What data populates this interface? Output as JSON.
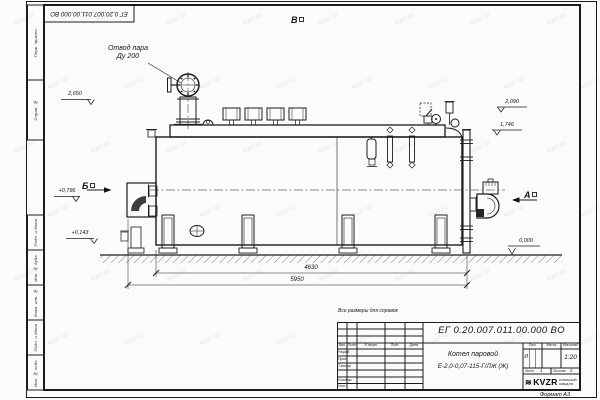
{
  "sheet": {
    "stamp_top": "ЕГ 0.20.007.011.00.000  ВО",
    "format_note": "Формат А3",
    "watermark": "kvzr.ru",
    "side_labels": {
      "perv": "Перв. примен.",
      "sprav": "Справ. №",
      "podp1": "Подп. и дата",
      "inv_dubl": "Инв. № дубл.",
      "vzam": "Взам. инв. №",
      "podp2": "Подп. и дата",
      "inv_podl": "Инв. № подл."
    }
  },
  "annotations": {
    "steam_line1": "Отвод пара",
    "steam_line2": "Ду 200",
    "view_top": "В",
    "view_left": "Б",
    "view_right": "А",
    "lvl_2650": "2,650",
    "lvl_2090": "2,090",
    "lvl_1746": "1,746",
    "lvl_0796": "+0,796",
    "lvl_0143": "+0,143",
    "lvl_0000": "0,000",
    "dim_inner": "4630",
    "dim_outer": "5950",
    "ref_note": "Все размеры для справок"
  },
  "title_block": {
    "doc_number": "ЕГ 0.20.007.011.00.000  ВО",
    "product_line1": "Котел паровой",
    "product_line2": "Е-2,0-0,07-115-Г/ЛЖ (Ж)",
    "col_izm": "Изм.",
    "col_list": "Лист",
    "col_ndok": "N докум.",
    "col_podp": "Подп.",
    "col_data": "Дата",
    "row_razrab": "Разраб.",
    "row_prov": "Пров.",
    "row_tkontr": "Т.контр.",
    "row_nkontr": "Н.контр.",
    "row_utv": "Утв.",
    "lit_header": "Лит.",
    "mass_header": "Масса",
    "scale_header": "Масштаб",
    "lit_value": "И",
    "scale_value": "1:20",
    "sheet_label": "Лист",
    "sheet_value": "1",
    "sheets_label": "Листов",
    "sheets_value": "2",
    "logo_text": "KVZR",
    "logo_sub1": "КОТЕЛЬНЫЙ",
    "logo_sub2": "ЗАВОД РФ"
  }
}
